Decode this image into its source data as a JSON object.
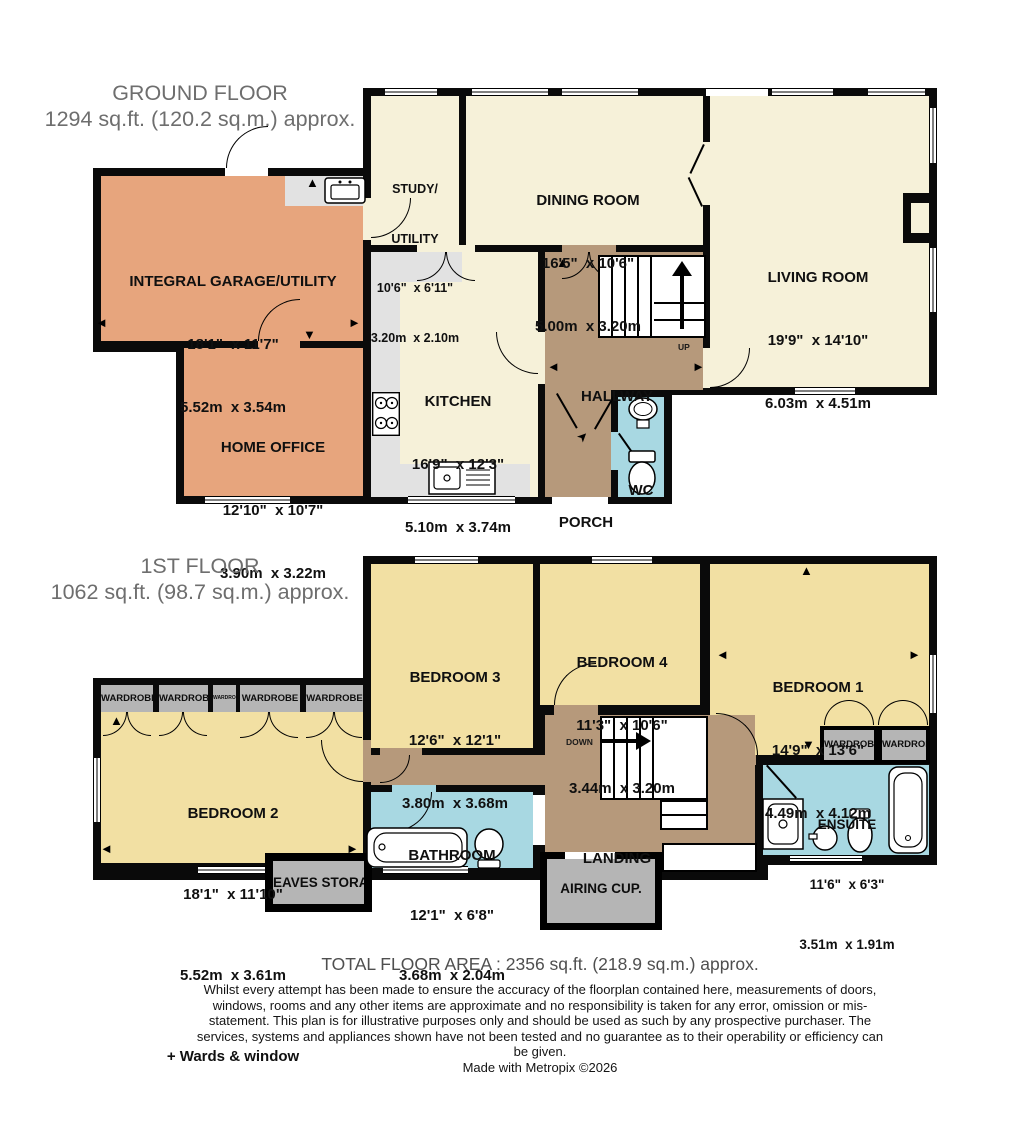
{
  "ground_floor": {
    "title": "GROUND FLOOR",
    "area": "1294 sq.ft. (120.2 sq.m.) approx.",
    "labels": {
      "up": "UP"
    },
    "rooms": {
      "garage": {
        "name": "INTEGRAL GARAGE/UTILITY",
        "imperial": "18'1\"  x 11'7\"",
        "metric": "5.52m  x 3.54m"
      },
      "home_office": {
        "name": "HOME OFFICE",
        "imperial": "12'10\"  x 10'7\"",
        "metric": "3.90m  x 3.22m"
      },
      "study": {
        "name_line1": "STUDY/",
        "name_line2": "UTILITY",
        "imperial": "10'6\"  x 6'11\"",
        "metric": "3.20m  x 2.10m"
      },
      "dining": {
        "name": "DINING ROOM",
        "imperial": "16'5\"  x 10'6\"",
        "metric": "5.00m  x 3.20m"
      },
      "living": {
        "name": "LIVING ROOM",
        "imperial": "19'9\"  x 14'10\"",
        "metric": "6.03m  x 4.51m"
      },
      "kitchen": {
        "name": "KITCHEN",
        "imperial": "16'9\"  x 12'3\"",
        "metric": "5.10m  x 3.74m"
      },
      "hallway": {
        "name": "HALLWAY"
      },
      "wc": {
        "name": "WC"
      },
      "porch": {
        "name": "PORCH"
      }
    }
  },
  "first_floor": {
    "title": "1ST FLOOR",
    "area": "1062 sq.ft. (98.7 sq.m.) approx.",
    "labels": {
      "down": "DOWN",
      "wardrobe": "WARDROBE",
      "eaves": "EAVES STORAGE",
      "airing": "AIRING CUP."
    },
    "rooms": {
      "bedroom1": {
        "name": "BEDROOM 1",
        "imperial": "14'9\"  x 13'6\"",
        "metric": "4.49m  x 4.12m"
      },
      "bedroom2": {
        "name": "BEDROOM 2",
        "imperial": "18'1\"  x 11'10\"",
        "metric": "5.52m  x 3.61m",
        "extra": "+ Wards & window"
      },
      "bedroom3": {
        "name": "BEDROOM 3",
        "imperial": "12'6\"  x 12'1\"",
        "metric": "3.80m  x 3.68m"
      },
      "bedroom4": {
        "name": "BEDROOM 4",
        "imperial": "11'3\"  x 10'6\"",
        "metric": "3.44m  x 3.20m"
      },
      "bathroom": {
        "name": "BATHROOM",
        "imperial": "12'1\"  x 6'8\"",
        "metric": "3.68m  x 2.04m"
      },
      "ensuite": {
        "name": "ENSUITE",
        "imperial": "11'6\"  x 6'3\"",
        "metric": "3.51m  x 1.91m"
      },
      "landing": {
        "name": "LANDING"
      }
    }
  },
  "footer": {
    "total_area": "TOTAL FLOOR AREA : 2356 sq.ft. (218.9 sq.m.) approx.",
    "disclaimer": "Whilst every attempt has been made to ensure the accuracy of the floorplan contained here, measurements of doors, windows, rooms and any other items are approximate and no responsibility is taken for any error, omission or mis-statement. This plan is for illustrative purposes only and should be used as such by any prospective purchaser. The services, systems and appliances shown have not been tested and no guarantee as to their operability or efficiency can be given.",
    "credit": "Made with Metropix ©2026"
  },
  "colors": {
    "garage_office": "#E7A57D",
    "reception": "#F6F1D9",
    "counters": "#E2E2E2",
    "circulation": "#B6997B",
    "sanitary": "#A8D8E2",
    "bedrooms": "#F2E0A3",
    "storage_boxes": "#B5B5B5",
    "walls": "#0A0A0A",
    "title_text": "#6E6E6E"
  }
}
